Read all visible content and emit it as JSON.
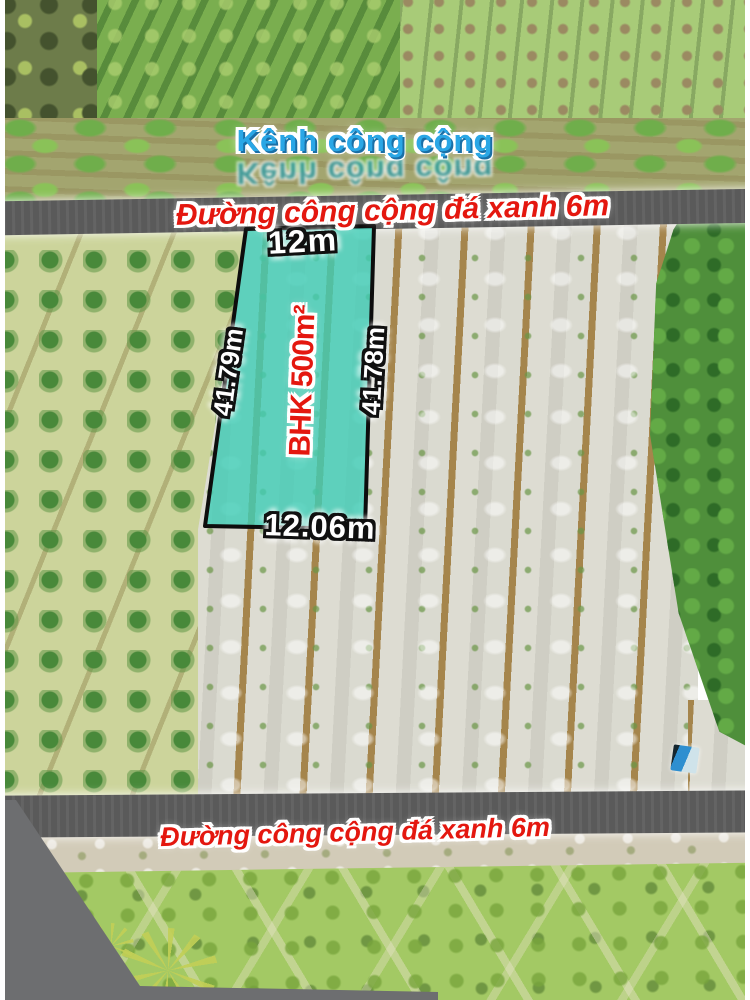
{
  "scene": {
    "canal_label": "Kênh công cộng",
    "top_road_label": "Đường công cộng đá xanh 6m",
    "bottom_road_label": "Đường công cộng đá xanh 6m",
    "plot": {
      "area_label": "BHK 500m²",
      "top_edge": "12m",
      "left_edge": "41.79m",
      "right_edge": "41.78m",
      "bottom_edge": "12.06m"
    },
    "colors": {
      "canal_text": "#2aa7e6",
      "road_text": "#e4170f",
      "road_surface": "#5a5a5a",
      "plot_fill": "#3ecdb6",
      "plot_outline": "#0d0d0d",
      "measurement_text": "#ffffff",
      "area_text": "#e4130b"
    }
  }
}
